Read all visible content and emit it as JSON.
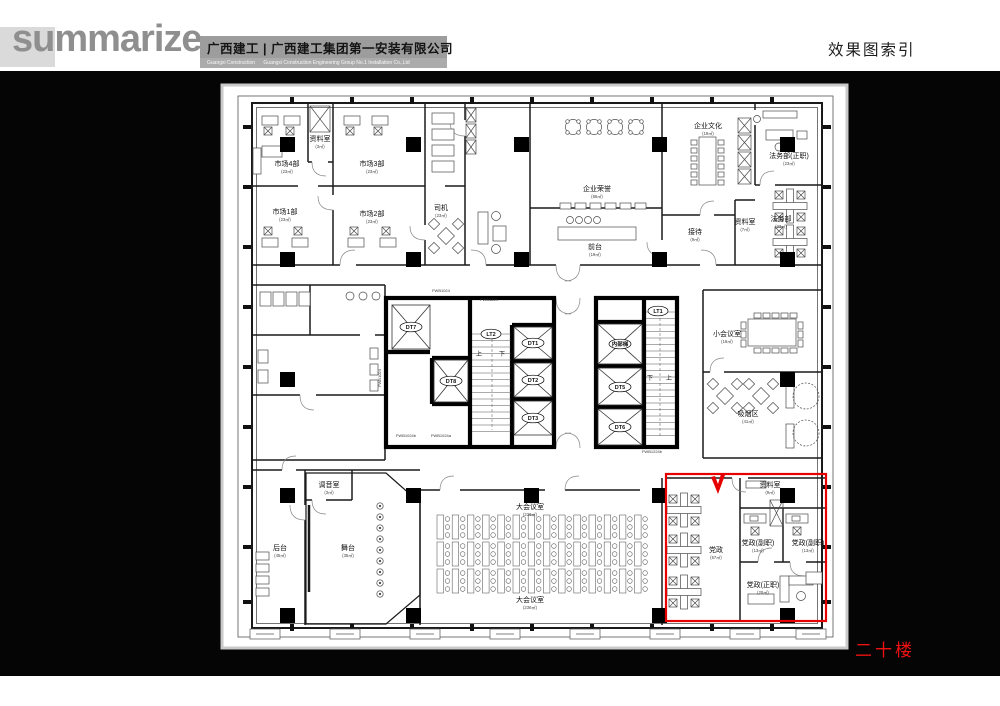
{
  "header": {
    "logo": "summarize",
    "company_cn": "广西建工 | 广西建工集团第一安装有限公司",
    "company_en": "Guangxi Construction      Guangxi Construction Engineering Group No.1 Installation Co.,Ltd",
    "page_title": "效果图索引"
  },
  "floor_label": "二十楼",
  "colors": {
    "highlight_red": "#e60000",
    "floor_label_red": "#ee1111",
    "header_bar_gray": "#9d9d9d",
    "logo_gray": "#8f8f8f"
  },
  "plan": {
    "rooms": [
      {
        "label": "市场4部",
        "sub": "(23㎡)",
        "x": 287,
        "y": 166
      },
      {
        "label": "资料室",
        "sub": "(3㎡)",
        "x": 320,
        "y": 141
      },
      {
        "label": "市场3部",
        "sub": "(23㎡)",
        "x": 372,
        "y": 166
      },
      {
        "label": "市场1部",
        "sub": "(23㎡)",
        "x": 285,
        "y": 214
      },
      {
        "label": "市场2部",
        "sub": "(23㎡)",
        "x": 372,
        "y": 216
      },
      {
        "label": "司机",
        "sub": "(23㎡)",
        "x": 441,
        "y": 210
      },
      {
        "label": "企业荣誉",
        "sub": "(86㎡)",
        "x": 597,
        "y": 191
      },
      {
        "label": "前台",
        "sub": "(19㎡)",
        "x": 595,
        "y": 249
      },
      {
        "label": "接待",
        "sub": "(9㎡)",
        "x": 695,
        "y": 234
      },
      {
        "label": "资料室",
        "sub": "(7㎡)",
        "x": 745,
        "y": 224
      },
      {
        "label": "企业文化",
        "sub": "(19㎡)",
        "x": 708,
        "y": 128
      },
      {
        "label": "法务部(正职)",
        "sub": "(23㎡)",
        "x": 789,
        "y": 158
      },
      {
        "label": "法务部",
        "sub": "(23㎡)",
        "x": 781,
        "y": 221
      },
      {
        "label": "小会议室",
        "sub": "(16㎡)",
        "x": 727,
        "y": 336
      },
      {
        "label": "吸烟区",
        "sub": "(41㎡)",
        "x": 748,
        "y": 416
      },
      {
        "label": "调音室",
        "sub": "(3㎡)",
        "x": 329,
        "y": 487
      },
      {
        "label": "后台",
        "sub": "(45㎡)",
        "x": 280,
        "y": 550
      },
      {
        "label": "舞台",
        "sub": "(35㎡)",
        "x": 348,
        "y": 550
      },
      {
        "label": "大会议室",
        "sub": "(236㎡)",
        "x": 530,
        "y": 509
      },
      {
        "label": "大会议室",
        "sub": "(236㎡)",
        "x": 530,
        "y": 602
      },
      {
        "label": "党政",
        "sub": "(57㎡)",
        "x": 716,
        "y": 552
      },
      {
        "label": "资料室",
        "sub": "(9㎡)",
        "x": 770,
        "y": 487
      },
      {
        "label": "党政(副职)",
        "sub": "(13㎡)",
        "x": 758,
        "y": 545
      },
      {
        "label": "党政(副职)",
        "sub": "(13㎡)",
        "x": 808,
        "y": 545
      },
      {
        "label": "党政(正职)",
        "sub": "(20㎡)",
        "x": 763,
        "y": 587
      }
    ],
    "elevators": [
      {
        "label": "DT7",
        "x": 411,
        "y": 329
      },
      {
        "label": "DT8",
        "x": 451,
        "y": 383
      },
      {
        "label": "DT1",
        "x": 533,
        "y": 345
      },
      {
        "label": "DT2",
        "x": 533,
        "y": 382
      },
      {
        "label": "DT3",
        "x": 533,
        "y": 420
      },
      {
        "label": "内部梯",
        "x": 620,
        "y": 346
      },
      {
        "label": "DT5",
        "x": 620,
        "y": 389
      },
      {
        "label": "DT6",
        "x": 620,
        "y": 429
      }
    ],
    "stairs": [
      {
        "label": "LT2",
        "x": 491,
        "y": 336
      },
      {
        "label": "LT1",
        "x": 658,
        "y": 313
      }
    ],
    "door_labels": [
      {
        "label": "FWB1024",
        "x": 441,
        "y": 292,
        "rot": 0
      },
      {
        "label": "FWB1224",
        "x": 489,
        "y": 301,
        "rot": 0
      },
      {
        "label": "FWB1024",
        "x": 381,
        "y": 378,
        "rot": -90
      },
      {
        "label": "FWB1024b",
        "x": 406,
        "y": 437,
        "rot": 0
      },
      {
        "label": "FWB1024a",
        "x": 441,
        "y": 437,
        "rot": 0
      },
      {
        "label": "FWB1224b",
        "x": 652,
        "y": 453,
        "rot": 0
      }
    ],
    "directions": [
      {
        "label": "上",
        "x": 479,
        "y": 356
      },
      {
        "label": "下",
        "x": 502,
        "y": 356
      },
      {
        "label": "下",
        "x": 650,
        "y": 380
      },
      {
        "label": "上",
        "x": 669,
        "y": 380
      }
    ]
  }
}
